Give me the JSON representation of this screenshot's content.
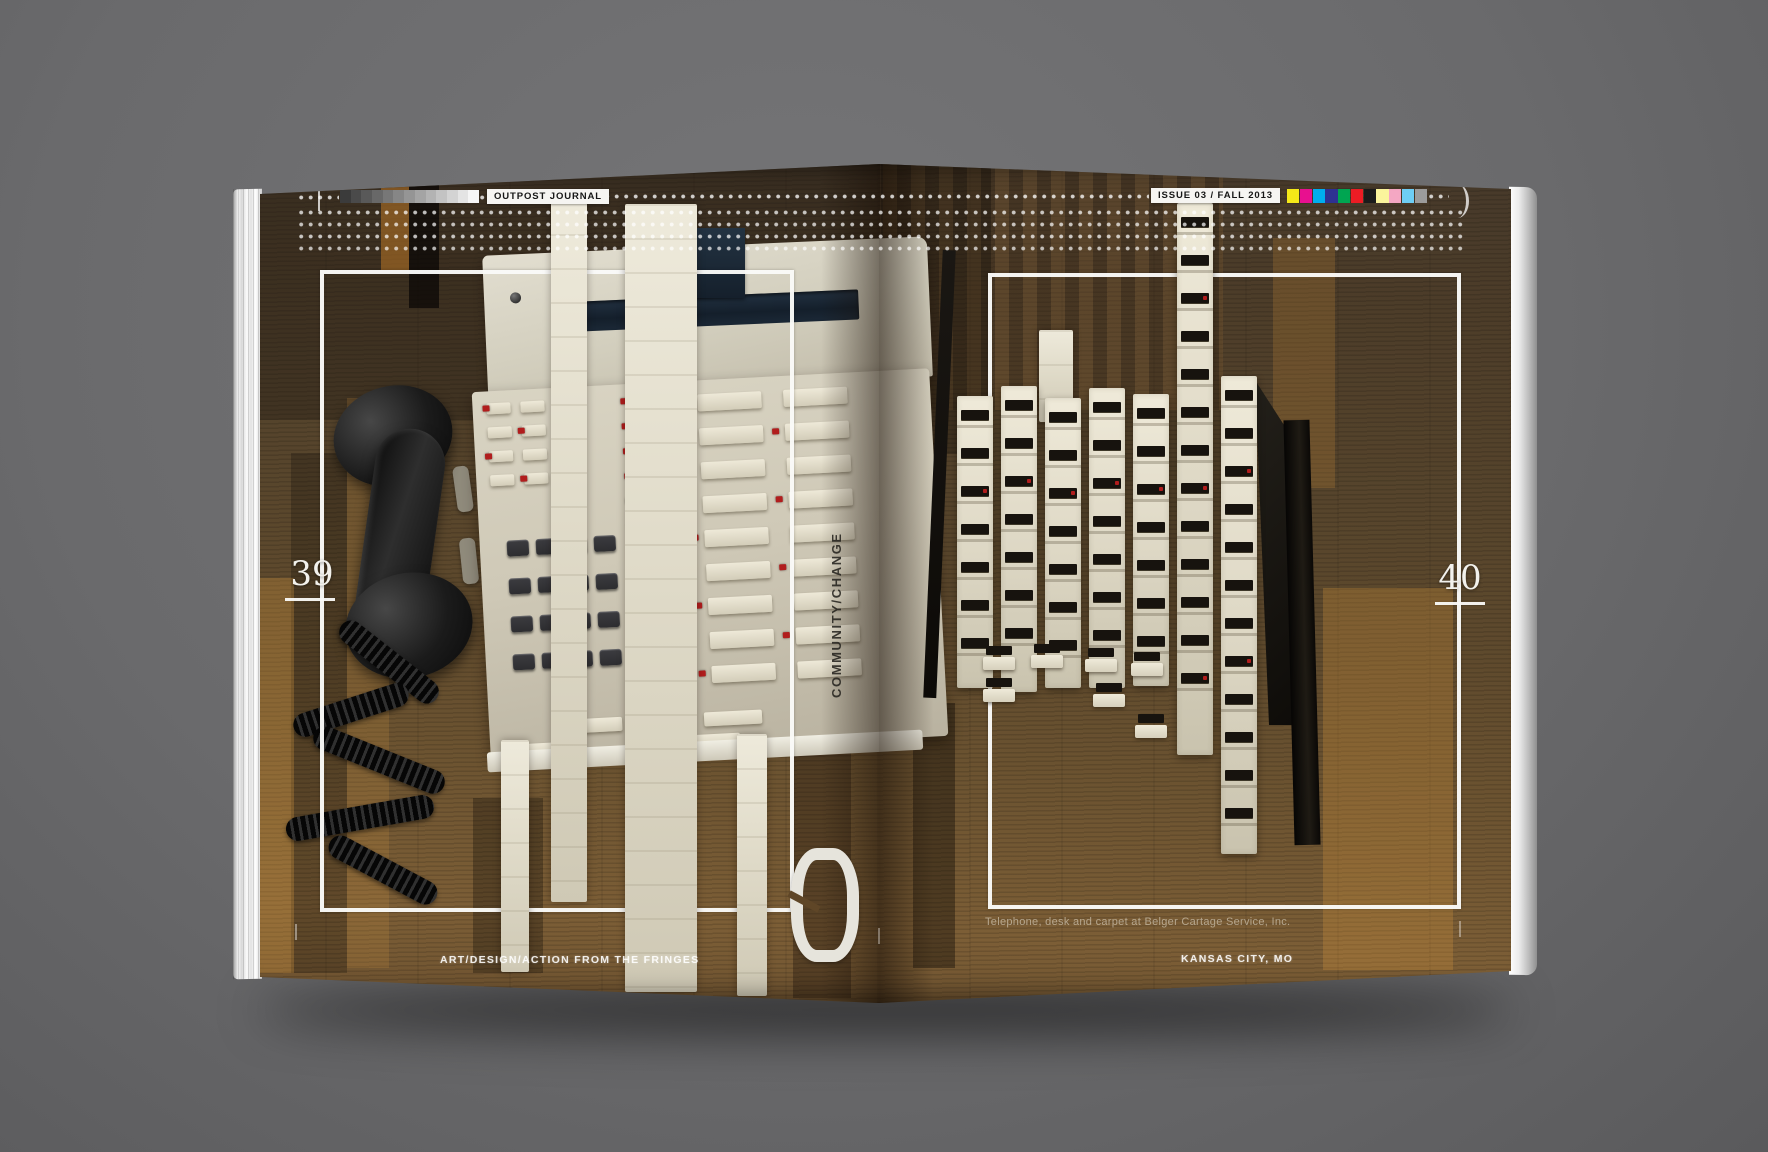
{
  "scene": {
    "backdrop_color": "#6b6b6d"
  },
  "header": {
    "journal_label": "OUTPOST JOURNAL",
    "issue_label": "ISSUE 03 / FALL 2013",
    "grayscale_bar": [
      "#3b3b3b",
      "#4a4a4a",
      "#595959",
      "#686868",
      "#777777",
      "#868686",
      "#959595",
      "#a4a4a4",
      "#b3b3b3",
      "#c3c3c3",
      "#d3d3d3",
      "#e4e4e4",
      "#f6f6f6"
    ],
    "color_bar": [
      "#f5e918",
      "#e8108f",
      "#00adee",
      "#2e3192",
      "#00a551",
      "#ec1c24",
      "#1b1b1b",
      "#fbf49c",
      "#f4a7c3",
      "#6ecef5",
      "#9c9c9c"
    ]
  },
  "pages": {
    "left_number": "39",
    "right_number": "40"
  },
  "spine_text": "COMMUNITY/CHANGE",
  "big_glyph": "0",
  "caption": "Telephone, desk and carpet at Belger Cartage Service, Inc.",
  "footer": {
    "left": "ART/DESIGN/ACTION FROM THE FRINGES",
    "right": "KANSAS CITY, MO"
  },
  "photo": {
    "subject": "Glitched photograph of a beige multi-line office telephone and button console on a wood desk",
    "wood_color": "#55432b",
    "phone_body_color": "#d5d0bf",
    "console_key_color": "#e8e3d1",
    "keypad_key_color": "#2d2d30",
    "led_color": "#b11d1d",
    "label_chip_color": "#17130e",
    "handset_color": "#151515",
    "display_color": "#1a2633"
  }
}
